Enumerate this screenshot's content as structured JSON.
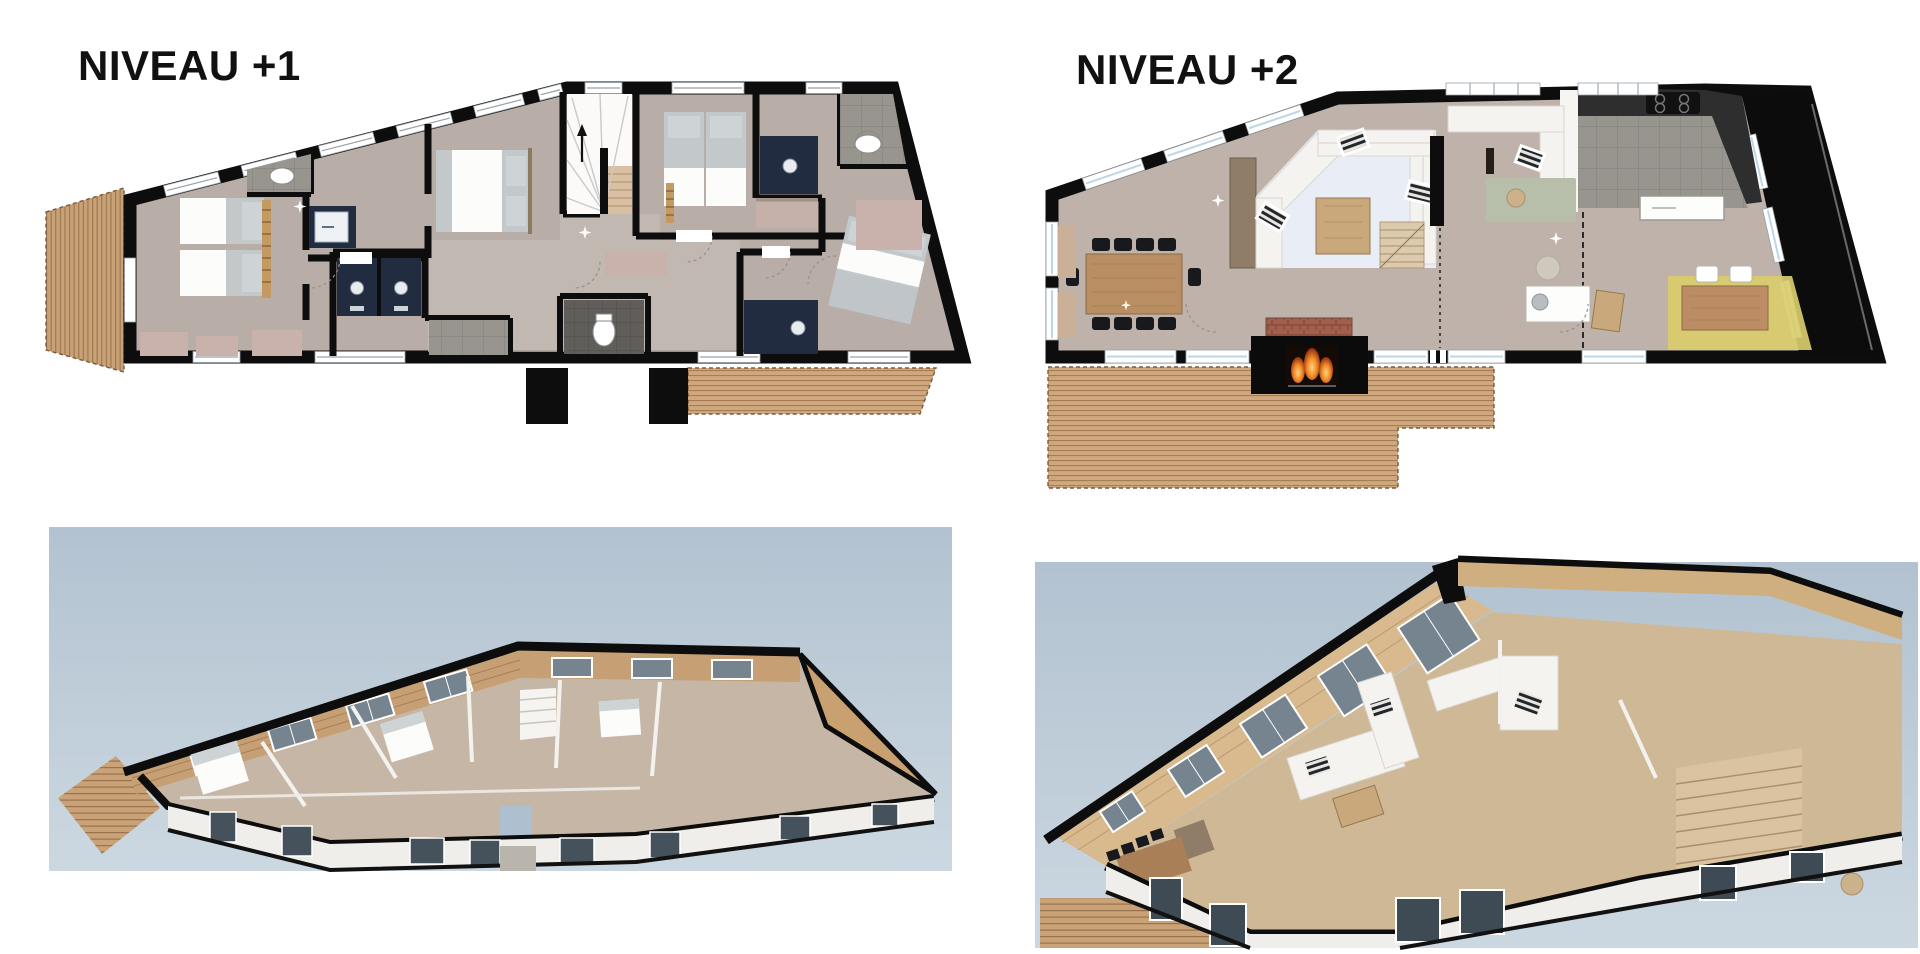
{
  "panels": {
    "plan_level1": {
      "title": "NIVEAU +1"
    },
    "plan_level2": {
      "title": "NIVEAU +2"
    }
  },
  "palette": {
    "background": "#ffffff",
    "title_ink": "#111111",
    "wall": "#0d0d0d",
    "floor_level1": "#b9ada7",
    "floor_level2": "#beb2aa",
    "corridor": "#c6bcb6",
    "glass_blue": "#bcd6e8",
    "deck_vertical": "#c8a176",
    "deck_horizontal": "#d0a87f",
    "vanity_navy": "#222c41",
    "tile_gray": "#97958d",
    "rug_rose": "#c9b2ab",
    "rug_yellow": "#d9cc6d",
    "rug_green": "#b7bfab",
    "rug_blue": "#e8edf6",
    "sofa_white": "#f4f3f0",
    "wood_furniture": "#b98e62",
    "brick": "#a2604c",
    "fire_orange": "#e2611c",
    "sky_top": "#b2c2d0",
    "sky_bottom": "#ccd8e1",
    "wood_3d": "#d8ba8e",
    "window_3d": "#76848f",
    "exterior_wall_3d": "#efeeea"
  }
}
